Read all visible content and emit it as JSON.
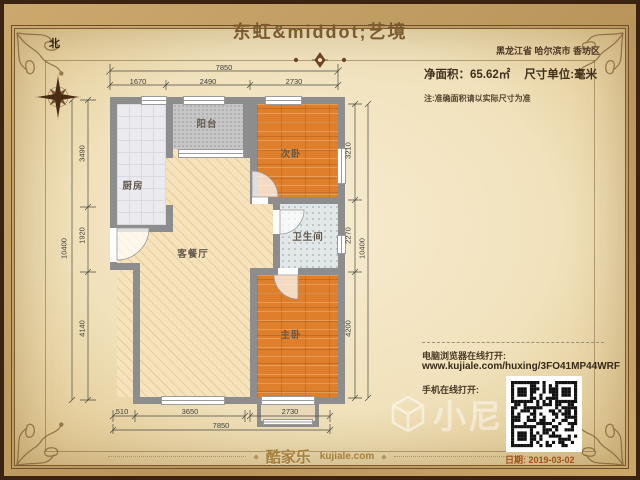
{
  "title": "东虹&middot;艺境",
  "region": "黑龙江省 哈尔滨市 香坊区",
  "compass": {
    "north_label": "北"
  },
  "area": {
    "net_area": "净面积：65.62㎡",
    "unit": "尺寸单位:毫米",
    "note": "注:准确面积请以实际尺寸为准"
  },
  "rooms": {
    "kitchen": "厨房",
    "balcony": "阳台",
    "bedroom2": "次卧",
    "bathroom": "卫生间",
    "living": "客餐厅",
    "master": "主卧"
  },
  "dims": {
    "top_total": "7850",
    "top_seg1": "1670",
    "top_seg2": "2490",
    "top_seg3": "2730",
    "bottom_seg1": "510",
    "bottom_seg2": "3650",
    "bottom_seg3": "2730",
    "bottom_total": "7850",
    "left_total": "10400",
    "left_seg1": "3490",
    "left_seg2": "1920",
    "left_seg3": "4140",
    "right_total": "10400",
    "right_seg1": "3210",
    "right_seg2": "2270",
    "right_seg3": "4200"
  },
  "share": {
    "pc_label": "电脑浏览器在线打开:",
    "url": "www.kujiale.com/huxing/3FO41MP44WRF",
    "mobile_label": "手机在线打开:"
  },
  "footer": {
    "brand": "酷家乐",
    "brand_domain": "kujiale.com",
    "date": "日期: 2019-03-02"
  },
  "watermark": {
    "text": "小尼"
  },
  "colors": {
    "accent_brown": "#7a5a2e",
    "date_orange": "#a4511c",
    "wall_gray": "#8d8d8d",
    "wood_orange": "#df7f2c",
    "paper": "#f1e2bc"
  }
}
